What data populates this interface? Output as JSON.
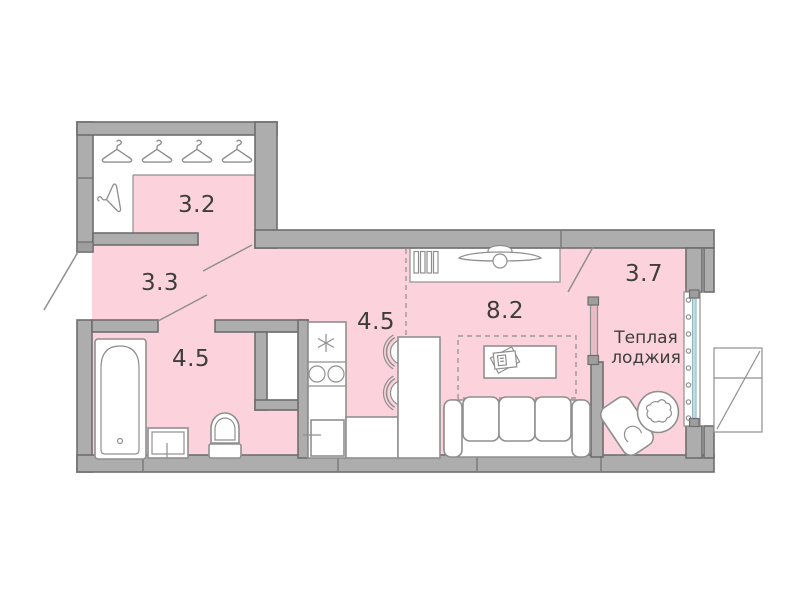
{
  "floorplan": {
    "rooms": {
      "wardrobe": {
        "area": "3.2"
      },
      "hallway": {
        "area": "3.3"
      },
      "bathroom": {
        "area": "4.5"
      },
      "kitchen": {
        "area": "4.5"
      },
      "living_room": {
        "area": "8.2"
      },
      "loggia": {
        "area": "3.7",
        "label_line1": "Теплая",
        "label_line2": "лоджия"
      }
    },
    "icons": [
      "hanger-icon",
      "bathtub-icon",
      "sink-icon",
      "toilet-icon",
      "cooktop-icon",
      "extractor-icon",
      "fridge-icon",
      "bar-counter",
      "bar-stool-icon",
      "tv-console-icon",
      "coffee-table-icon",
      "sofa-icon",
      "chair-icon",
      "plant-table-icon",
      "window-glazing",
      "door-swing",
      "balcony-box",
      "shaft"
    ],
    "colors": {
      "room_fill": "#fcd2dc",
      "wall_fill": "#adadad",
      "wall_edge": "#6e6e6e",
      "furniture_stroke": "#8f8f8f",
      "glass": "#bedde9",
      "partition_glass": "#e7bcc7",
      "text": "#3d3d3d"
    }
  }
}
